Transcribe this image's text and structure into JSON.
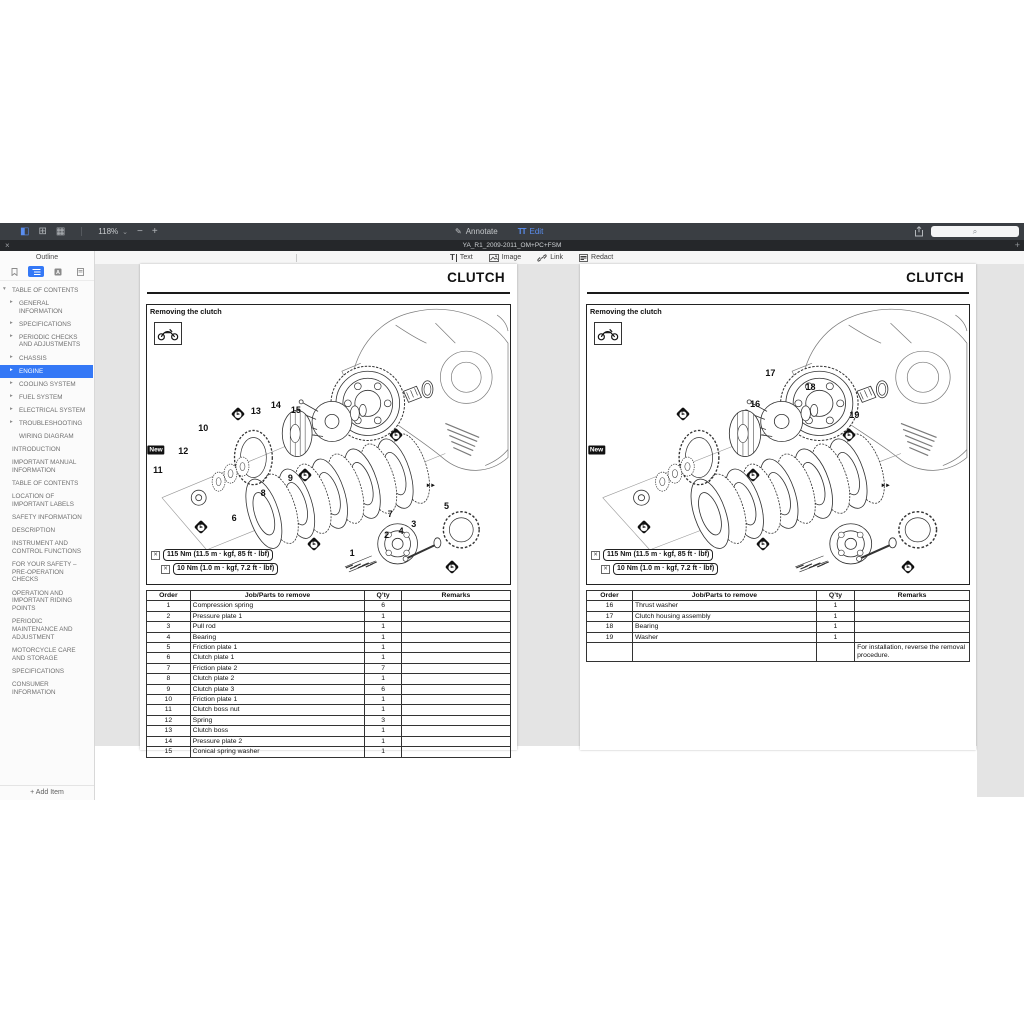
{
  "toolbar": {
    "zoom_level": "118%",
    "annotate_label": "Annotate",
    "edit_label": "Edit"
  },
  "icons": {
    "sidebar_toggle": "◧",
    "pages_grid": "⊞",
    "reading_mode": "▦",
    "chevron_down": "⌄",
    "zoom_out": "−",
    "zoom_in": "+",
    "annotate_pencil": "✎",
    "edit_tt": "TT",
    "search_magnifier": "⌕",
    "close_tab": "×",
    "add_tab": "+",
    "text_tool": "T",
    "wrench": "✕",
    "bolt_arrows": "►►"
  },
  "tab_bar": {
    "title": "YA_R1_2009-2011_OM+PC+FSM"
  },
  "edit_toolbar": {
    "text_label": "Text",
    "image_label": "Image",
    "link_label": "Link",
    "redact_label": "Redact"
  },
  "search": {
    "placeholder": ""
  },
  "sidebar": {
    "title": "Outline",
    "add_item_label": "+ Add Item",
    "toc": [
      {
        "label": "TABLE OF CONTENTS",
        "level": 0,
        "arrow": "down",
        "selected": false
      },
      {
        "label": "GENERAL INFORMATION",
        "level": 1,
        "arrow": "right",
        "selected": false
      },
      {
        "label": "SPECIFICATIONS",
        "level": 1,
        "arrow": "right",
        "selected": false
      },
      {
        "label": "PERIODIC CHECKS AND ADJUSTMENTS",
        "level": 1,
        "arrow": "right",
        "selected": false
      },
      {
        "label": "CHASSIS",
        "level": 1,
        "arrow": "right",
        "selected": false
      },
      {
        "label": "ENGINE",
        "level": 1,
        "arrow": "right",
        "selected": true
      },
      {
        "label": "COOLING SYSTEM",
        "level": 1,
        "arrow": "right",
        "selected": false
      },
      {
        "label": "FUEL SYSTEM",
        "level": 1,
        "arrow": "right",
        "selected": false
      },
      {
        "label": "ELECTRICAL SYSTEM",
        "level": 1,
        "arrow": "right",
        "selected": false
      },
      {
        "label": "TROUBLESHOOTING",
        "level": 1,
        "arrow": "right",
        "selected": false
      },
      {
        "label": "WIRING DIAGRAM",
        "level": 1,
        "arrow": "none",
        "selected": false
      },
      {
        "label": "INTRODUCTION",
        "level": 0,
        "arrow": "none",
        "selected": false
      },
      {
        "label": "IMPORTANT MANUAL INFORMATION",
        "level": 0,
        "arrow": "none",
        "selected": false
      },
      {
        "label": "TABLE OF CONTENTS",
        "level": 0,
        "arrow": "none",
        "selected": false
      },
      {
        "label": "LOCATION OF IMPORTANT LABELS",
        "level": 0,
        "arrow": "none",
        "selected": false
      },
      {
        "label": "SAFETY INFORMATION",
        "level": 0,
        "arrow": "none",
        "selected": false
      },
      {
        "label": "DESCRIPTION",
        "level": 0,
        "arrow": "none",
        "selected": false
      },
      {
        "label": "INSTRUMENT AND CONTROL FUNCTIONS",
        "level": 0,
        "arrow": "none",
        "selected": false
      },
      {
        "label": "FOR YOUR SAFETY – PRE-OPERATION CHECKS",
        "level": 0,
        "arrow": "none",
        "selected": false
      },
      {
        "label": "OPERATION AND IMPORTANT RIDING POINTS",
        "level": 0,
        "arrow": "none",
        "selected": false
      },
      {
        "label": "PERIODIC MAINTENANCE AND ADJUSTMENT",
        "level": 0,
        "arrow": "none",
        "selected": false
      },
      {
        "label": "MOTORCYCLE CARE AND STORAGE",
        "level": 0,
        "arrow": "none",
        "selected": false
      },
      {
        "label": "SPECIFICATIONS",
        "level": 0,
        "arrow": "none",
        "selected": false
      },
      {
        "label": "CONSUMER INFORMATION",
        "level": 0,
        "arrow": "none",
        "selected": false
      }
    ]
  },
  "colors": {
    "accent_blue": "#3478f6",
    "toolbar_bg": "#3a3e43",
    "tabbar_bg": "#25272a",
    "canvas_bg": "#e4e4e4",
    "selection_bg": "#3478f6"
  },
  "pages": [
    {
      "title": "CLUTCH",
      "section_heading": "Removing the clutch",
      "torque_specs": [
        "115 Nm (11.5 m · kgf, 85 ft · lbf)",
        "10 Nm (1.0 m · kgf, 7.2 ft · lbf)"
      ],
      "diagram_labels": [
        {
          "type": "new",
          "text": "New",
          "x": 2.5,
          "y": 52
        },
        {
          "type": "num",
          "text": "11",
          "x": 3,
          "y": 59
        },
        {
          "type": "num",
          "text": "12",
          "x": 10,
          "y": 52.5
        },
        {
          "type": "num",
          "text": "10",
          "x": 15.5,
          "y": 44
        },
        {
          "type": "num",
          "text": "13",
          "x": 30,
          "y": 38
        },
        {
          "type": "num",
          "text": "14",
          "x": 35.5,
          "y": 36
        },
        {
          "type": "num",
          "text": "15",
          "x": 41,
          "y": 37.5
        },
        {
          "type": "num",
          "text": "8",
          "x": 32,
          "y": 67.5
        },
        {
          "type": "num",
          "text": "9",
          "x": 39.5,
          "y": 62
        },
        {
          "type": "num",
          "text": "6",
          "x": 24,
          "y": 76.5
        },
        {
          "type": "num",
          "text": "7",
          "x": 67,
          "y": 75
        },
        {
          "type": "num",
          "text": "5",
          "x": 82.5,
          "y": 72
        },
        {
          "type": "num",
          "text": "3",
          "x": 73.5,
          "y": 78.5
        },
        {
          "type": "num",
          "text": "4",
          "x": 70,
          "y": 81
        },
        {
          "type": "num",
          "text": "2",
          "x": 66,
          "y": 82.5
        },
        {
          "type": "num",
          "text": "1",
          "x": 56.5,
          "y": 89
        },
        {
          "type": "oil",
          "text": "E",
          "x": 25,
          "y": 39
        },
        {
          "type": "oil",
          "text": "E",
          "x": 15,
          "y": 79.5
        },
        {
          "type": "oil",
          "text": "E",
          "x": 43.5,
          "y": 61
        },
        {
          "type": "oil",
          "text": "E",
          "x": 46,
          "y": 85.5
        },
        {
          "type": "oil",
          "text": "E",
          "x": 68.5,
          "y": 46.5
        },
        {
          "type": "oil",
          "text": "E",
          "x": 84,
          "y": 94
        },
        {
          "type": "bolt",
          "text": "",
          "x": 78,
          "y": 65
        }
      ],
      "table": {
        "headers": [
          "Order",
          "Job/Parts to remove",
          "Q’ty",
          "Remarks"
        ],
        "rows": [
          [
            "1",
            "Compression spring",
            "6",
            ""
          ],
          [
            "2",
            "Pressure plate 1",
            "1",
            ""
          ],
          [
            "3",
            "Pull rod",
            "1",
            ""
          ],
          [
            "4",
            "Bearing",
            "1",
            ""
          ],
          [
            "5",
            "Friction plate 1",
            "1",
            ""
          ],
          [
            "6",
            "Clutch plate 1",
            "1",
            ""
          ],
          [
            "7",
            "Friction plate 2",
            "7",
            ""
          ],
          [
            "8",
            "Clutch plate 2",
            "1",
            ""
          ],
          [
            "9",
            "Clutch plate 3",
            "6",
            ""
          ],
          [
            "10",
            "Friction plate 1",
            "1",
            ""
          ],
          [
            "11",
            "Clutch boss nut",
            "1",
            ""
          ],
          [
            "12",
            "Spring",
            "3",
            ""
          ],
          [
            "13",
            "Clutch boss",
            "1",
            ""
          ],
          [
            "14",
            "Pressure plate 2",
            "1",
            ""
          ],
          [
            "15",
            "Conical spring washer",
            "1",
            ""
          ]
        ]
      }
    },
    {
      "title": "CLUTCH",
      "section_heading": "Removing the clutch",
      "torque_specs": [
        "115 Nm (11.5 m · kgf, 85 ft · lbf)",
        "10 Nm (1.0 m · kgf, 7.2 ft · lbf)"
      ],
      "diagram_labels": [
        {
          "type": "new",
          "text": "New",
          "x": 2.5,
          "y": 52
        },
        {
          "type": "num",
          "text": "16",
          "x": 44,
          "y": 35.5
        },
        {
          "type": "num",
          "text": "17",
          "x": 48,
          "y": 24.5
        },
        {
          "type": "num",
          "text": "18",
          "x": 58.5,
          "y": 29.5
        },
        {
          "type": "num",
          "text": "19",
          "x": 70,
          "y": 39.5
        },
        {
          "type": "oil",
          "text": "E",
          "x": 25,
          "y": 39
        },
        {
          "type": "oil",
          "text": "E",
          "x": 15,
          "y": 79.5
        },
        {
          "type": "oil",
          "text": "E",
          "x": 43.5,
          "y": 61
        },
        {
          "type": "oil",
          "text": "E",
          "x": 46,
          "y": 85.5
        },
        {
          "type": "oil",
          "text": "E",
          "x": 68.5,
          "y": 46.5
        },
        {
          "type": "oil",
          "text": "E",
          "x": 84,
          "y": 94
        },
        {
          "type": "bolt",
          "text": "",
          "x": 78,
          "y": 65
        }
      ],
      "table": {
        "headers": [
          "Order",
          "Job/Parts to remove",
          "Q’ty",
          "Remarks"
        ],
        "rows": [
          [
            "16",
            "Thrust washer",
            "1",
            ""
          ],
          [
            "17",
            "Clutch housing assembly",
            "1",
            ""
          ],
          [
            "18",
            "Bearing",
            "1",
            ""
          ],
          [
            "19",
            "Washer",
            "1",
            ""
          ],
          [
            "",
            "",
            "",
            "For installation, reverse the removal procedure."
          ]
        ]
      }
    }
  ]
}
